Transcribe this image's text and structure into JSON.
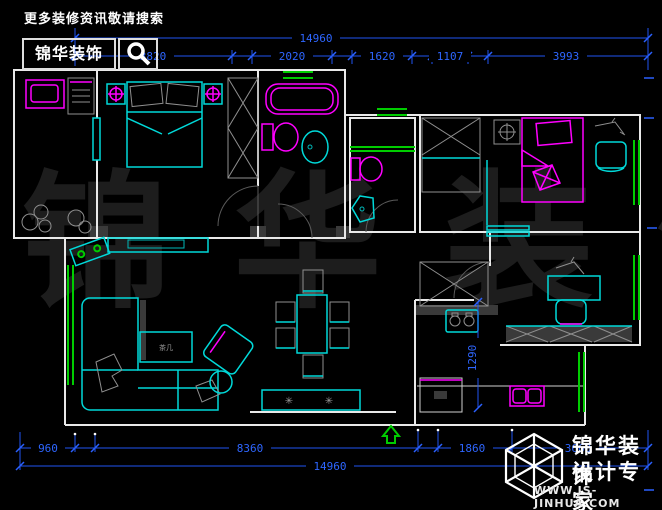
{
  "header": {
    "tagline": "更多装修资讯敬请搜索",
    "brand": "锦华装饰",
    "search_icon": "magnifier"
  },
  "watermark": "锦 华 装 饰",
  "dims": {
    "top_total": "14960",
    "top_segments": [
      "3820",
      "2020",
      "1620",
      "1107",
      "3993"
    ],
    "bottom_segments": [
      "960",
      "8360",
      "1860",
      "3660"
    ],
    "bottom_total": "14960",
    "kitchen_vertical": "1290"
  },
  "plan": {
    "coffee_table_label": "茶几",
    "console_star": "✳"
  },
  "footer": {
    "brand": "锦华装饰",
    "subtitle": "设计专家",
    "website": "WWW.JS-JINHUA.COM"
  },
  "colors": {
    "background": "#000000",
    "walls": "#e9e9e9",
    "furniture": "#00d9d9",
    "fixtures": "#ff00ff",
    "windows": "#00cc00",
    "dimensions": "#2e66ff",
    "watermark": "#1d1d1d"
  }
}
